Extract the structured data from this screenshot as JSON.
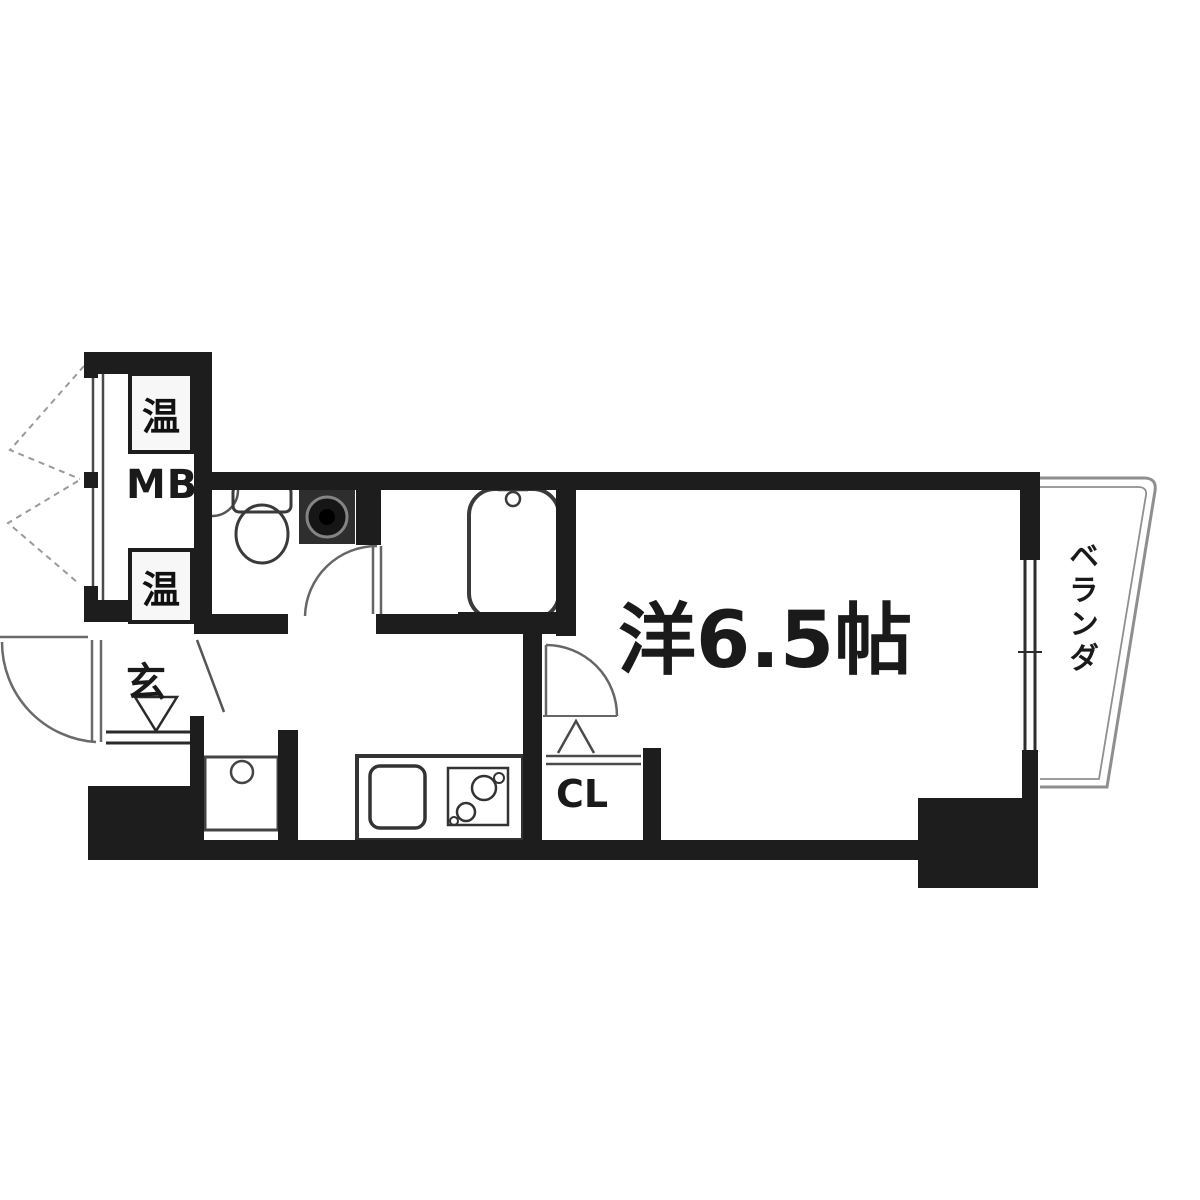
{
  "floorplan": {
    "labels": {
      "main_room": "洋6.5帖",
      "balcony": "ベランダ",
      "closet": "CL",
      "entrance": "玄",
      "meter_box": "MB",
      "heater_box_top": "温",
      "heater_box_bottom": "温"
    },
    "colors": {
      "wall": "#1d1d1d",
      "thin_line": "#555555",
      "balcony_line": "#8f8f8f",
      "appliance_fill": "#2e2e2e",
      "background": "#ffffff"
    }
  }
}
